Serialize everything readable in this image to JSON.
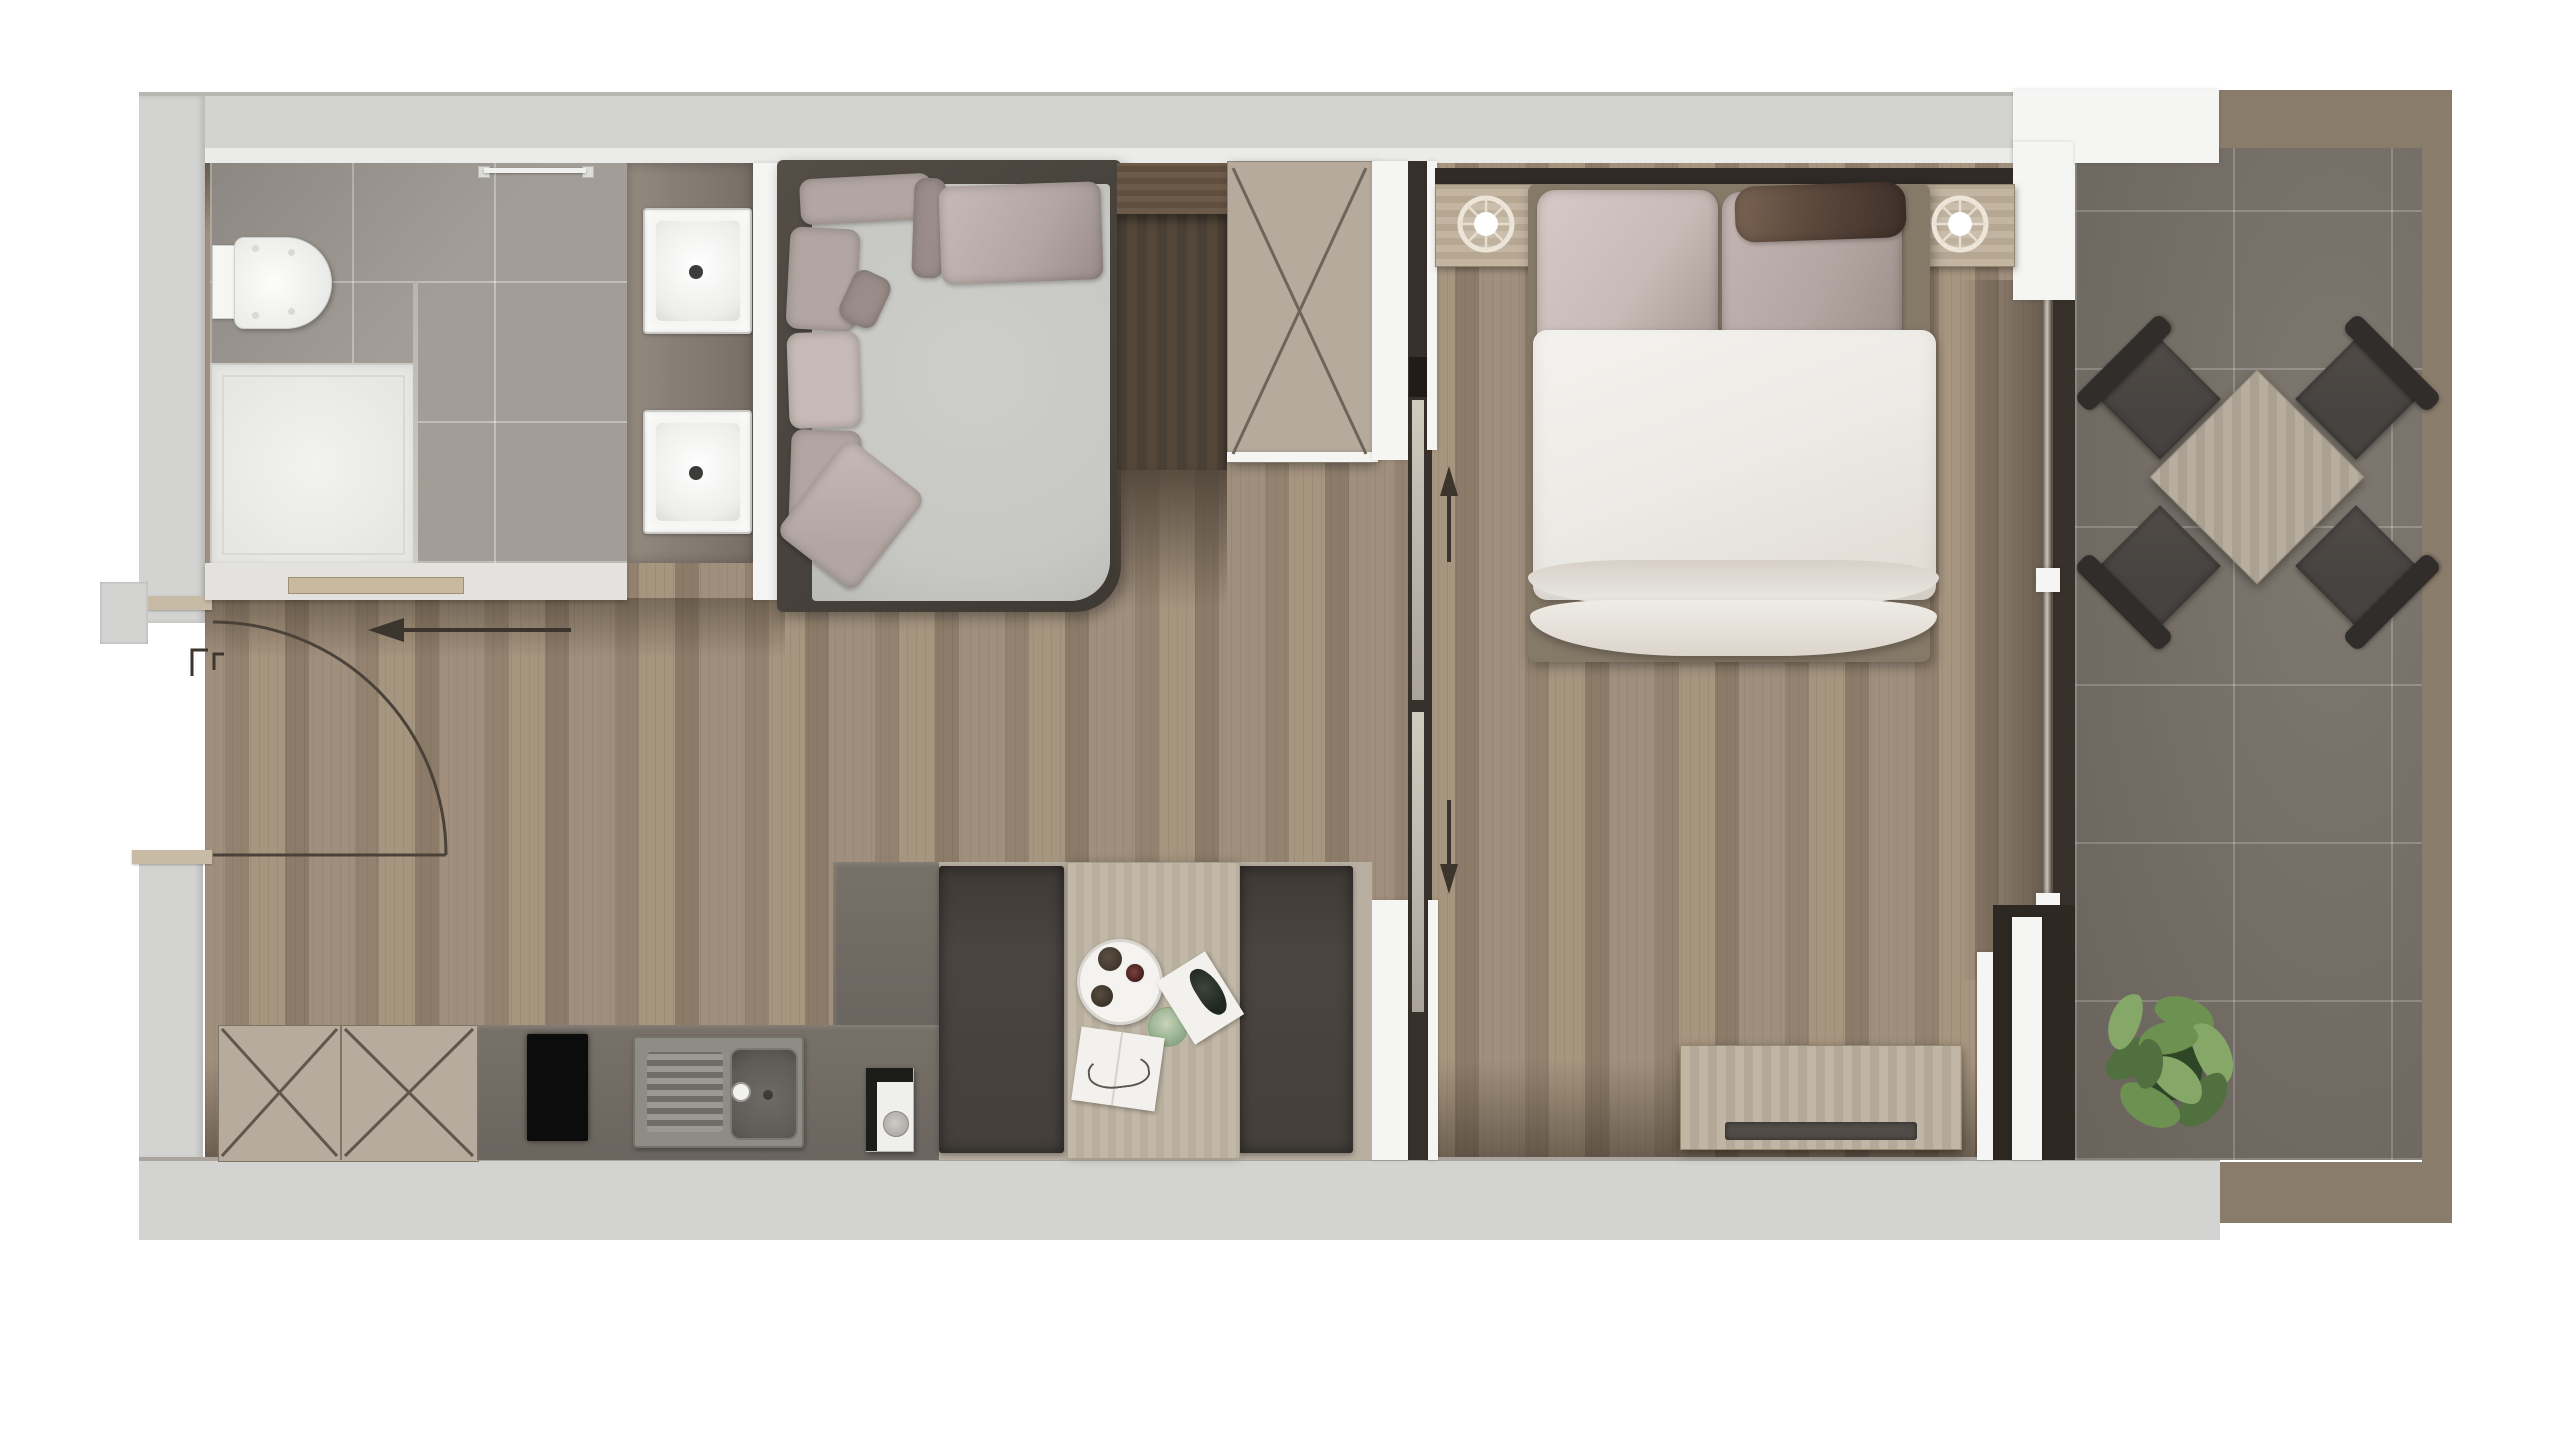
{
  "meta": {
    "title": "Studio apartment floor plan – top-down 3D render",
    "view": "plan view, no text labels",
    "width_px": 2560,
    "height_px": 1440
  },
  "palette": {
    "page_bg": "#ffffff",
    "wall": "#d3d3d1",
    "wall_stripe": "#ebebe9",
    "wall_edge": "#b7b6b3",
    "white_wall": "#f5f5f3",
    "bath_tile": "#a39d97",
    "vanity": "#8a8177",
    "sink_white": "#f4f4f2",
    "fixture_outline": "#c9c9c5",
    "wood_a": "#a08f7d",
    "wood_b": "#93826f",
    "wood_c": "#a6957f",
    "wood_d": "#8c7b69",
    "sofa_frame": "#49433d",
    "sofa_seat": "#c7c7c3",
    "pillow": "#b2a6a2",
    "pillow_light": "#c7bbb7",
    "pillow_dark": "#9a8d89",
    "cab_top": "#6d5b4a",
    "cab_dark": "#4b4035",
    "wardrobe": "#b5aa9c",
    "line_dark": "#60564b",
    "door_channel": "#38302a",
    "door_leaf": "#c2bcb2",
    "headboard": "#302b26",
    "nightstand": "#c3b5a1",
    "lamp_ring": "#ece5d8",
    "bed_pillow_a": "#c8bbb7",
    "bed_pillow_b": "#b3a5a1",
    "bolster": "#5c483c",
    "duvet": "#eceae5",
    "duvet_shade": "#d7d0c8",
    "bed_base": "#857968",
    "console": "#c1b6a6",
    "tv_bar": "#514c47",
    "balc_tile": "#787169",
    "balc_border": "#8a7c6b",
    "out_table": "#b8aea0",
    "chair_seat": "#474340",
    "chair_back": "#302d2a",
    "plant_a": "#51703f",
    "plant_b": "#6d9150",
    "plant_c": "#85a869",
    "plant_d": "#2e4526",
    "kcab": "#b6ab9d",
    "counter": "#6f6963",
    "cooktop": "#0c0c0c",
    "steel": "#8f8c86",
    "steel_dark": "#5e5b56",
    "bench": "#46403c",
    "din_table": "#c2b8a8",
    "underlay": "#b8afa1",
    "paper": "#f2f1ed",
    "arrow": "#3b352e",
    "glass_green": "#8fae8a"
  },
  "rooms": {
    "bathroom": {
      "label": "Bathroom",
      "items": [
        "toilet",
        "shower-tray",
        "glass-screen",
        "towel-rail",
        "double-sink-vanity",
        "ledge-shelf"
      ]
    },
    "living_room": {
      "label": "Living room",
      "items": [
        "corner-sofa",
        "throw-pillows",
        "tall-dark-cabinet",
        "wardrobe-with-x-doors"
      ]
    },
    "kitchen": {
      "label": "Kitchen",
      "items": [
        "x-front-base-cabinets",
        "dark-counter",
        "induction-hob",
        "stainless-sink",
        "counter-peninsula",
        "coffee-machine"
      ]
    },
    "dining": {
      "label": "Dining nook",
      "items": [
        "wood-table",
        "bench-left",
        "bench-right",
        "round-serving-tray",
        "cups",
        "green-glass",
        "magazine",
        "open-book"
      ]
    },
    "bedroom": {
      "label": "Bedroom",
      "items": [
        "headboard-wall",
        "nightstand-left",
        "table-lamp-left",
        "nightstand-right",
        "table-lamp-right",
        "double-bed",
        "pillows",
        "dark-bolster",
        "white-duvet",
        "media-console",
        "sliding-pocket-door"
      ]
    },
    "balcony": {
      "label": "Balcony",
      "items": [
        "square-outdoor-table",
        "outdoor-chair-nw",
        "outdoor-chair-ne",
        "outdoor-chair-sw",
        "outdoor-chair-se",
        "potted-plant",
        "sliding-glass-window"
      ]
    },
    "entrance": {
      "label": "Entrance hall",
      "items": [
        "entry-door-swing-arc",
        "entry-direction-arrow",
        "frame-brackets"
      ]
    }
  },
  "annotations": {
    "entry_arrow": "arrow pointing left into the apartment",
    "slide_up_arrow": "sliding-door travel direction up",
    "slide_down_arrow": "sliding-door travel direction down"
  }
}
